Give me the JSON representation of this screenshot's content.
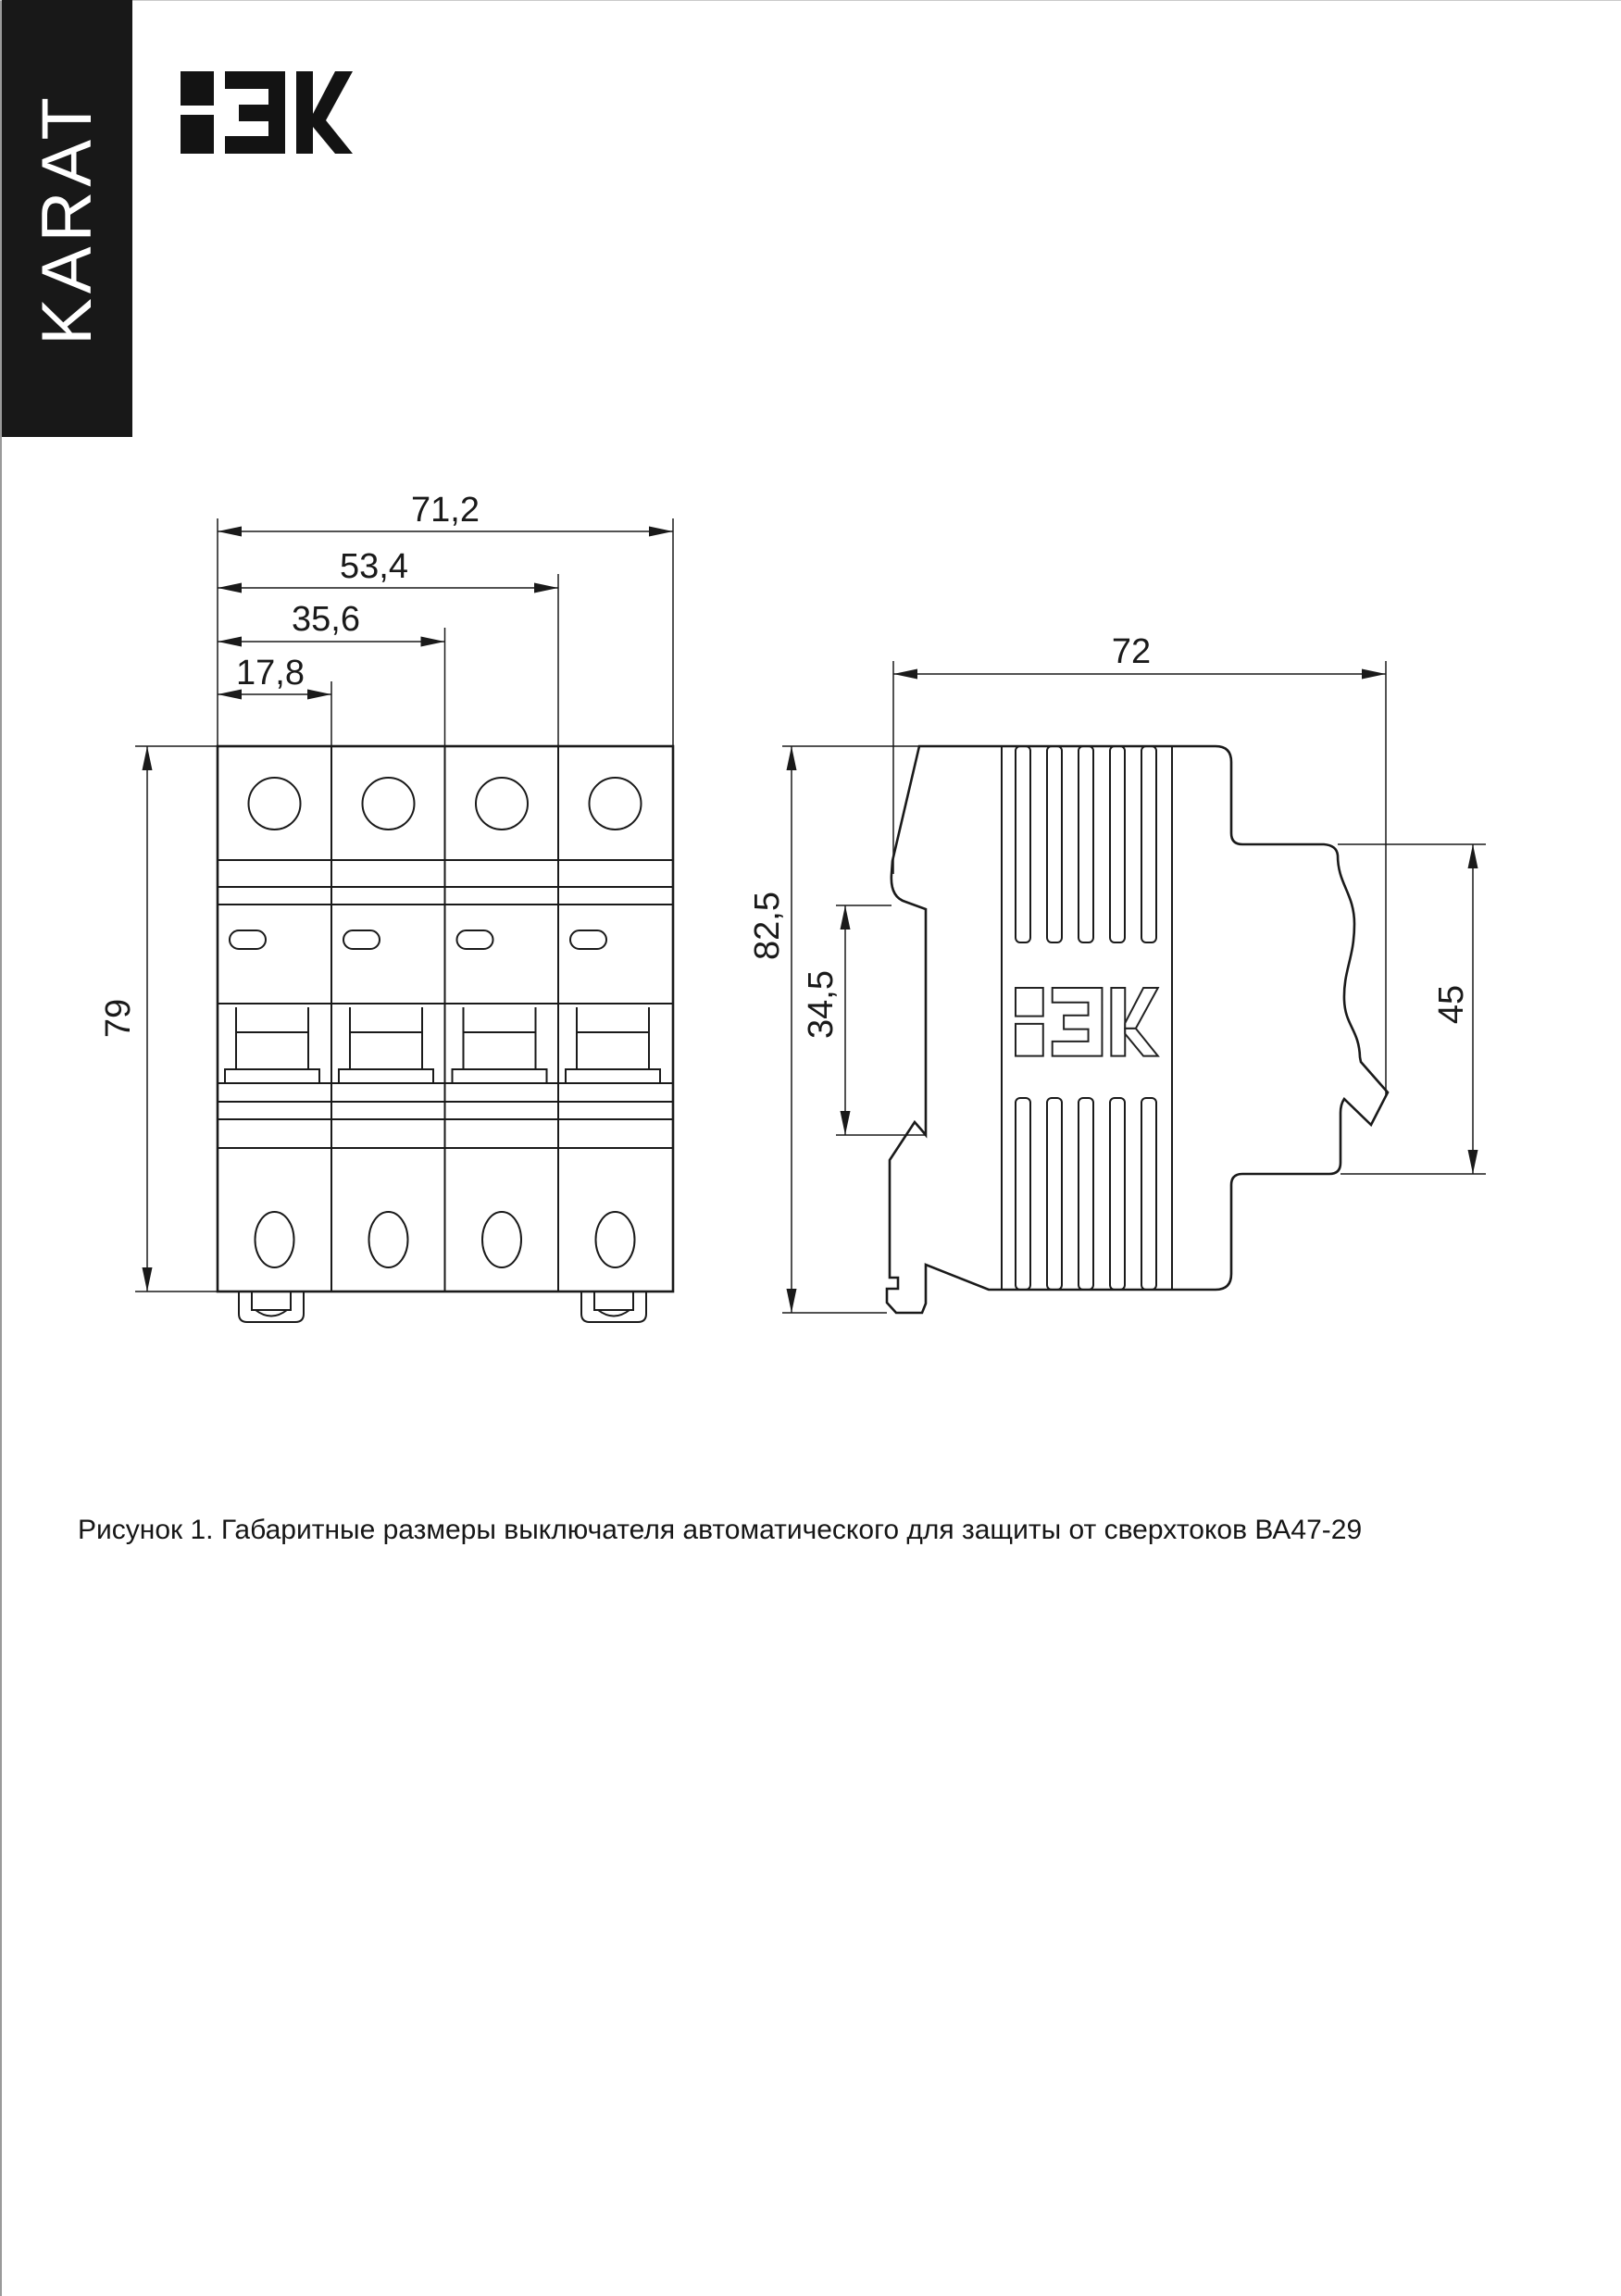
{
  "banner": {
    "brand": "KARAT"
  },
  "header": {
    "logo_text": "IEK"
  },
  "drawing": {
    "front_view": {
      "title": "front view of 4-pole circuit breaker",
      "dims": {
        "width_total": "71,2",
        "width_3poles": "53,4",
        "width_2poles": "35,6",
        "width_1pole": "17,8",
        "height": "79"
      }
    },
    "side_view": {
      "title": "side view of circuit breaker",
      "logo_text": "IEK",
      "dims": {
        "depth": "72",
        "height_total": "82,5",
        "din_channel": "34,5",
        "front_height": "45"
      }
    }
  },
  "caption": "Рисунок 1. Габаритные размеры выключателя автоматического для защиты от сверхтоков ВА47-29",
  "colors": {
    "ink": "#1a1a1a",
    "banner_bg": "#181818"
  }
}
